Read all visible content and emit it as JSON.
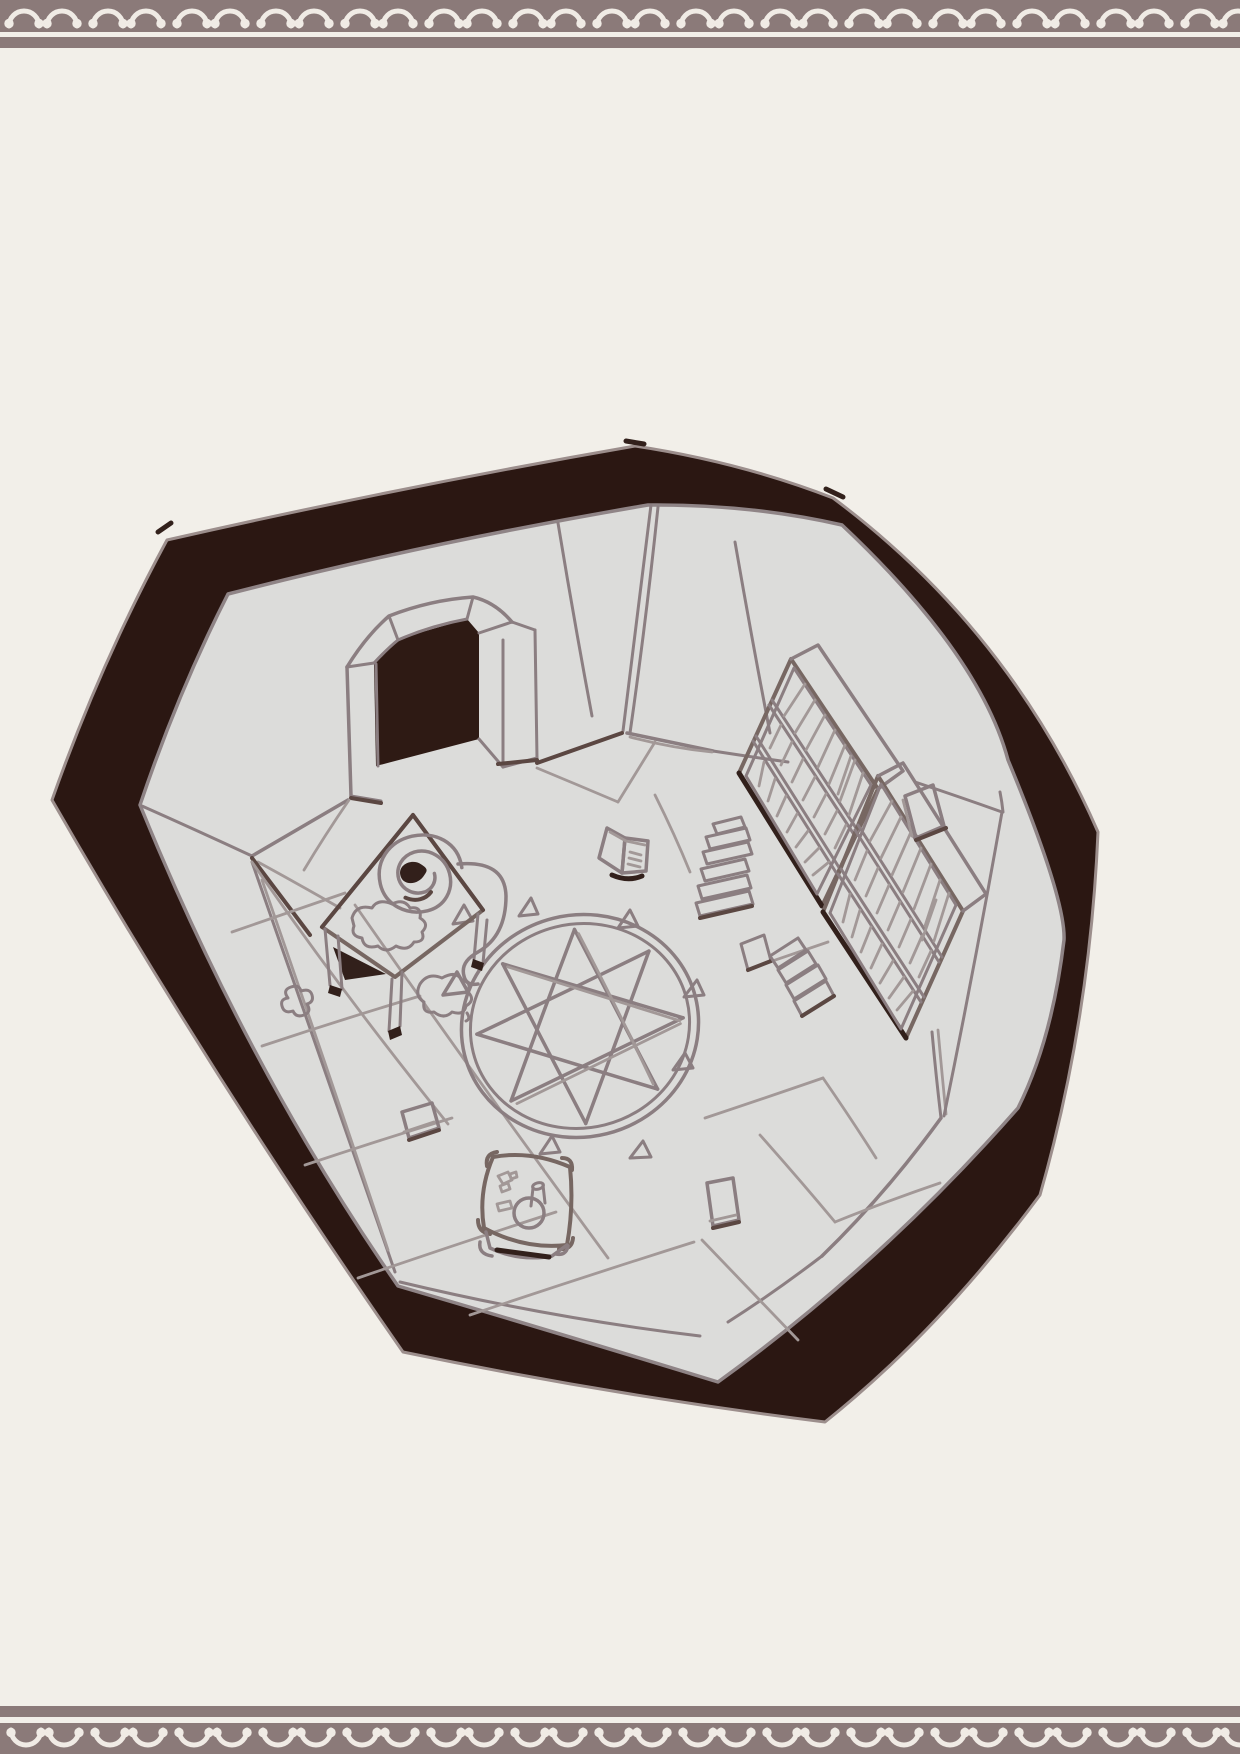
{
  "page": {
    "background_color": "#f2efe9",
    "description": "hand-drawn top-down fantasy room sketch framed by decorative lace borders"
  },
  "decorative_border": {
    "band_color": "#8b7a79",
    "lace_color": "#f0ebe5",
    "pattern": "scalloped-lace-arches"
  },
  "illustration": {
    "ring_color": "#2b1712",
    "room_fill": "#dcdcda",
    "door_color": "#2e1a14",
    "line_color": "#8b7e81",
    "line_soft": "#a29897",
    "line_strong": "#776762",
    "line_dark": "#5b4742",
    "ink_color": "#32201b",
    "outline_color": "#9c8e8c",
    "objects": [
      {
        "name": "stone-wall-ring"
      },
      {
        "name": "arched-doorway"
      },
      {
        "name": "tiled-floor"
      },
      {
        "name": "summoning-circle"
      },
      {
        "name": "ritual-triangles"
      },
      {
        "name": "writing-desk"
      },
      {
        "name": "scroll-spiral"
      },
      {
        "name": "scroll-ribbon"
      },
      {
        "name": "ink-stains"
      },
      {
        "name": "bookshelf-upper"
      },
      {
        "name": "bookshelf-lower"
      },
      {
        "name": "book-stacks"
      },
      {
        "name": "fallen-books"
      },
      {
        "name": "wall-leaning-book"
      },
      {
        "name": "open-book"
      },
      {
        "name": "floor-books"
      },
      {
        "name": "meditation-cushion"
      },
      {
        "name": "candle"
      }
    ]
  }
}
